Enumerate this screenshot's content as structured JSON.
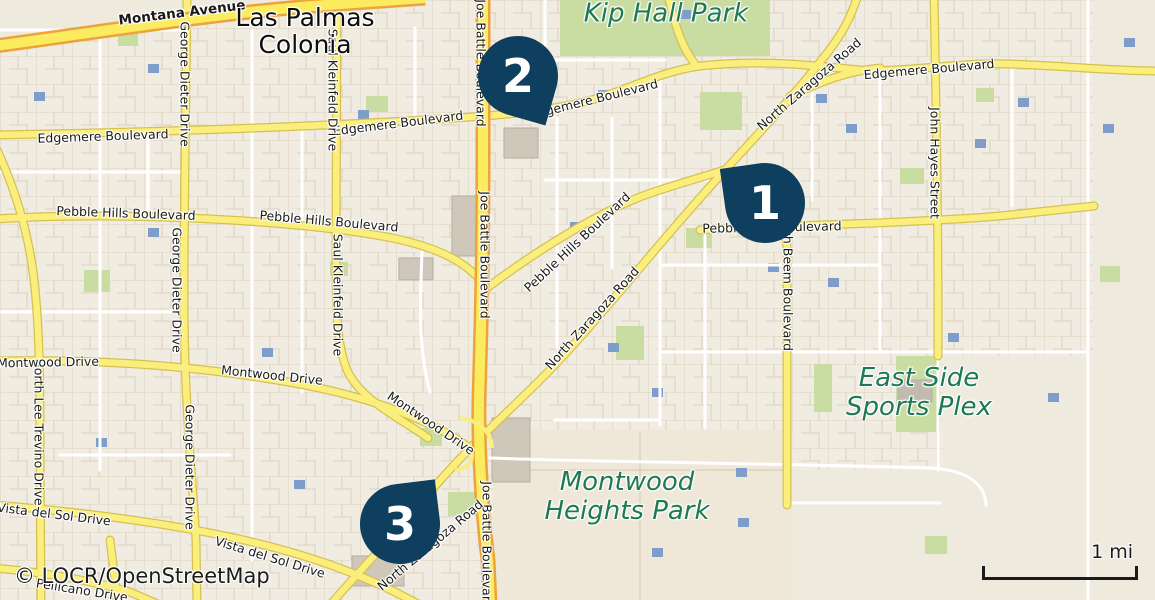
{
  "map": {
    "attribution": "© LOCR/OpenStreetMap",
    "scale_label": "1 mi",
    "markers": [
      {
        "number": "1"
      },
      {
        "number": "2"
      },
      {
        "number": "3"
      }
    ],
    "street_labels": [
      "Montana Avenue",
      "Edgemere Boulevard",
      "Edgemere Boulevard",
      "Edgemere Boulevard",
      "Edgemere Boulevard",
      "Pebble Hills Boulevard",
      "Pebble Hills Boulevard",
      "Pebble Hills Boulevard",
      "Pebble Hills Boulevard",
      "Joe Battle Boulevard",
      "Joe Battle Boulevard",
      "Joe Battle Boulevard",
      "George Dieter Drive",
      "George Dieter Drive",
      "George Dieter Drive",
      "Saul Kleinfeld Drive",
      "Saul Kleinfeld Drive",
      "John Hayes Street",
      "Rich Beem Boulevard",
      "North Lee Trevino Drive",
      "North Zaragoza Road",
      "North Zaragoza Road",
      "North Zaragoza Road",
      "Montwood Drive",
      "Montwood Drive",
      "Montwood Drive",
      "Vista del Sol Drive",
      "Vista del Sol Drive",
      "Pellicano Drive"
    ],
    "place_labels": [
      {
        "line1": "Las Palmas",
        "line2": "Colonia"
      },
      {
        "line1": "Kip Hall Park",
        "line2": ""
      },
      {
        "line1": "Montwood",
        "line2": "Heights Park"
      },
      {
        "line1": "East Side",
        "line2": "Sports Plex"
      }
    ],
    "colors": {
      "marker": "#0f3f5e",
      "marker_text": "#ffffff",
      "park_label": "#1e7a52",
      "major_road_fill": "#faef7d",
      "major_road_casing": "#d6c052",
      "highway_fill": "#fbec5f",
      "highway_casing": "#eca33e",
      "land": "#f0ece2",
      "park_green": "#c9dca2",
      "pool_blue": "#7e9dcb"
    }
  }
}
